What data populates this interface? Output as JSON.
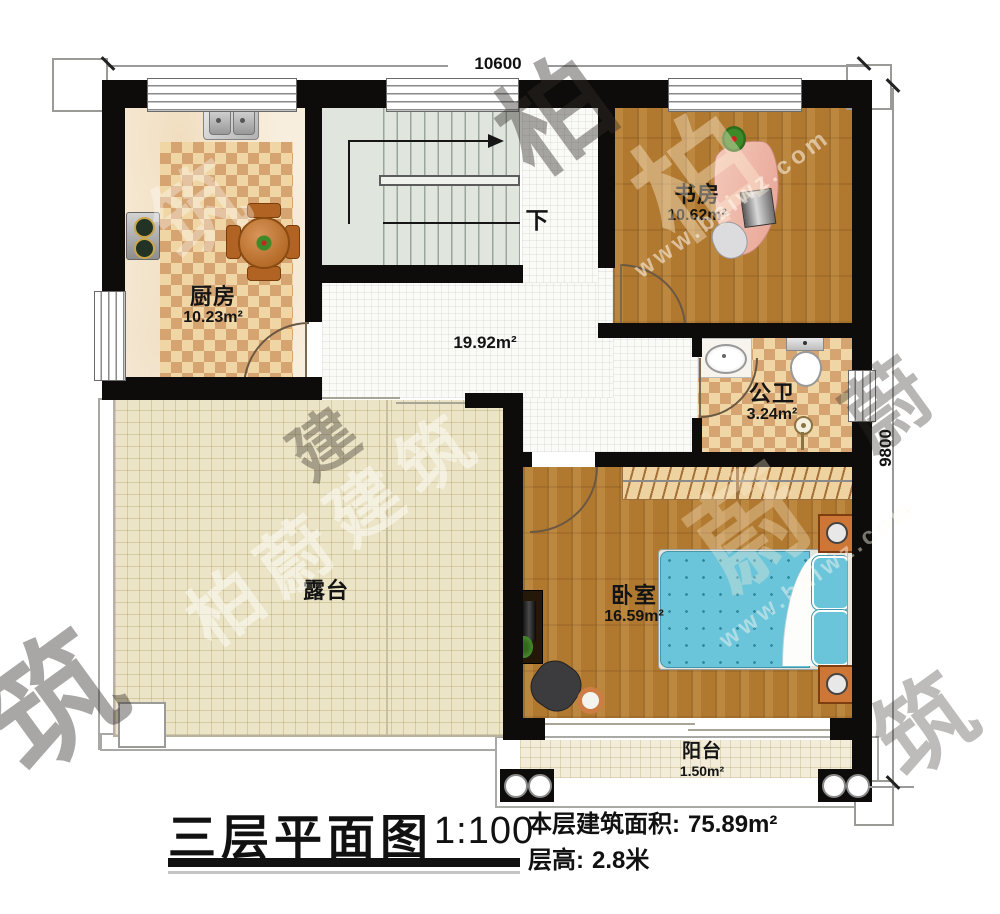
{
  "dimensions": {
    "top": "10600",
    "right": "9800"
  },
  "rooms": {
    "kitchen": {
      "name": "厨房",
      "area": "10.23m²"
    },
    "study": {
      "name": "书房",
      "area": "10.62m²"
    },
    "bathroom": {
      "name": "公卫",
      "area": "3.24m²"
    },
    "hall": {
      "area": "19.92m²"
    },
    "bedroom": {
      "name": "卧室",
      "area": "16.59m²"
    },
    "terrace": {
      "name": "露台"
    },
    "balcony": {
      "name": "阳台",
      "area": "1.50m²"
    }
  },
  "stairs": {
    "direction_label": "下"
  },
  "title_block": {
    "title": "三层平面图",
    "scale": "1:100",
    "floor_area_label": "本层建筑面积:",
    "floor_area_value": "75.89m²",
    "floor_height_label": "层高:",
    "floor_height_value": "2.8米"
  },
  "watermark": {
    "brand": "柏蔚建筑",
    "brand_chars": [
      "柏",
      "蔚",
      "建",
      "筑"
    ],
    "site": "www.baiwz.com"
  },
  "colors": {
    "wall": "#0d0c0a",
    "wood_floor": "#b1792f",
    "checker_dark": "#d6a471",
    "checker_light": "#f0d6a4",
    "hall_tile": "#fafaf7",
    "terrace": "#ece4c6",
    "stairs": "#e0e6de",
    "bed": "#6ac4da",
    "nightstand_orange": "#cd7635",
    "desk_pink": "#eab0a0"
  }
}
